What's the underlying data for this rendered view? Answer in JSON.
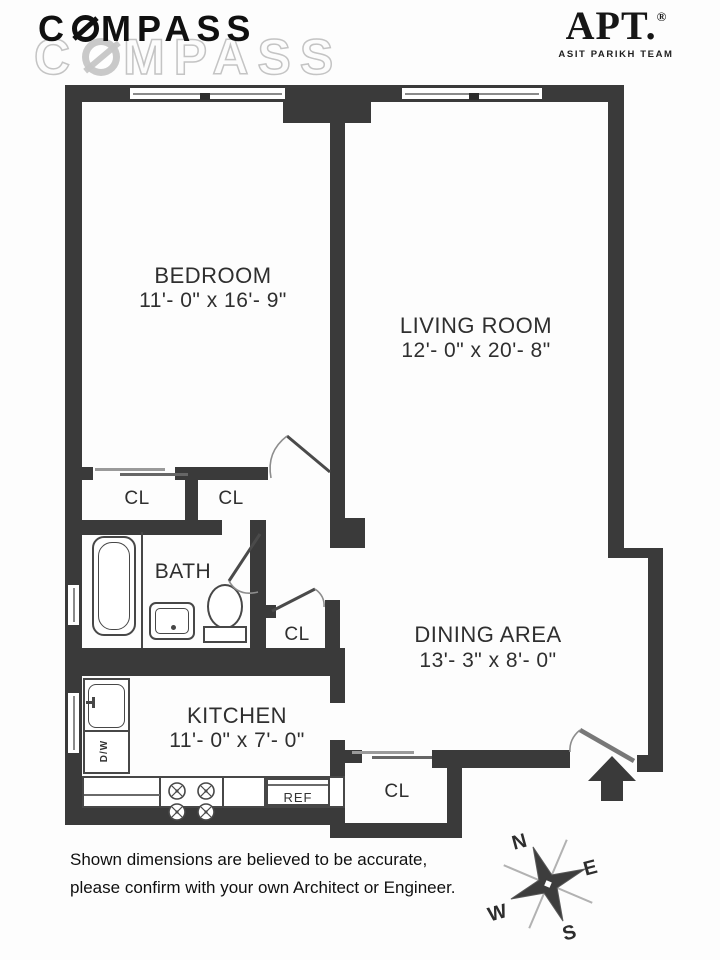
{
  "branding": {
    "compass_prefix": "C",
    "compass_suffix": "MPASS",
    "apt_name": "APT.",
    "apt_reg": "®",
    "apt_team": "ASIT PARIKH TEAM"
  },
  "rooms": {
    "bedroom": {
      "name": "BEDROOM",
      "dims": "11'- 0\" x 16'- 9\""
    },
    "living_room": {
      "name": "LIVING ROOM",
      "dims": "12'- 0\" x 20'- 8\""
    },
    "dining_area": {
      "name": "DINING AREA",
      "dims": "13'- 3\" x 8'- 0\""
    },
    "kitchen": {
      "name": "KITCHEN",
      "dims": "11'- 0\" x 7'- 0\""
    },
    "bath": {
      "name": "BATH"
    }
  },
  "closets": {
    "label": "CL"
  },
  "fixtures": {
    "refrigerator": "REF",
    "dishwasher": "D/W"
  },
  "compass_rose": {
    "north": "N",
    "east": "E",
    "south": "S",
    "west": "W"
  },
  "disclaimer": {
    "line1": "Shown dimensions are believed to be accurate,",
    "line2": "please confirm with your own Architect or Engineer."
  },
  "colors": {
    "wall": "#3a3a3a",
    "label": "#2f2f2f",
    "logo": "#101010",
    "watermark": "#e8e8e8"
  }
}
